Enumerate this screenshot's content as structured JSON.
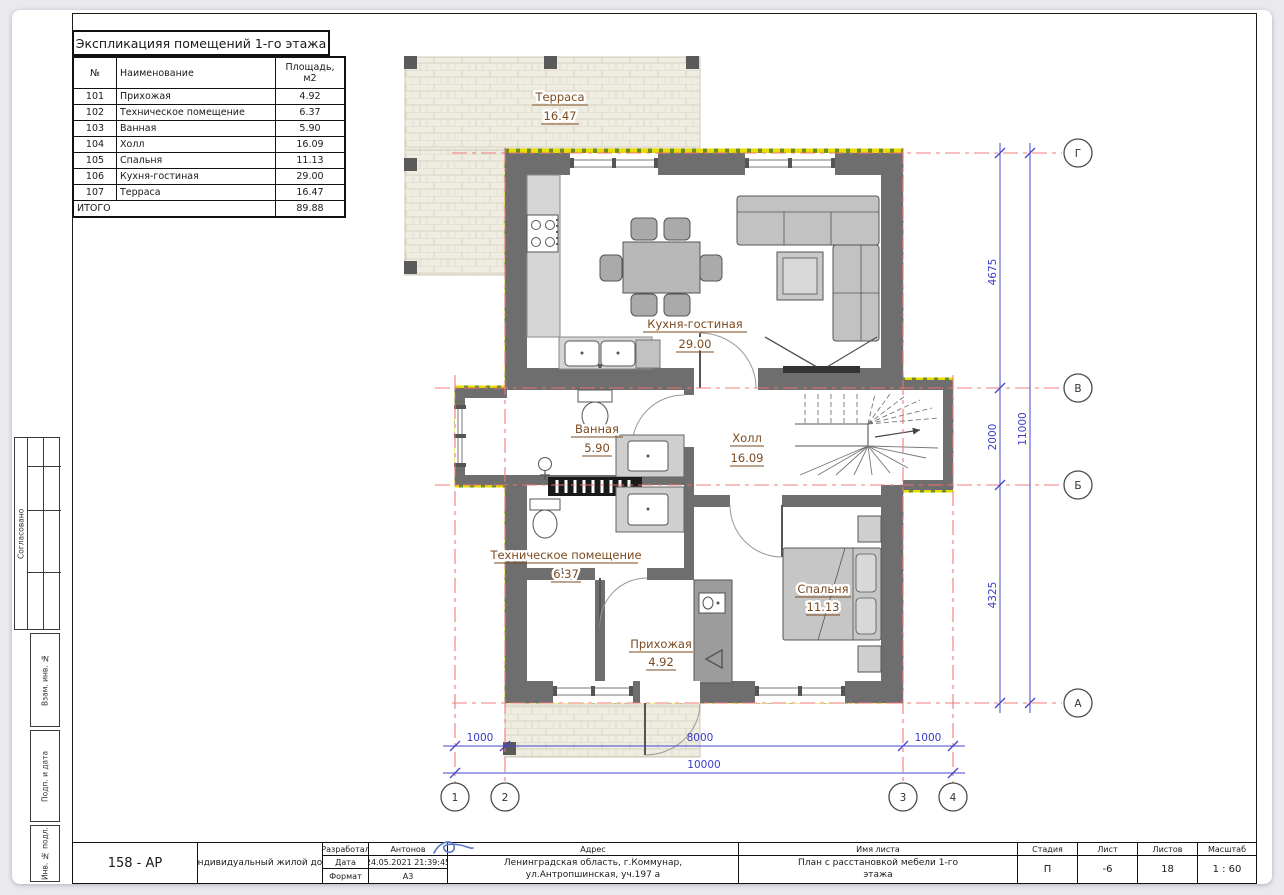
{
  "schedule": {
    "title": "Экспликацияя помещений 1-го этажа",
    "col_num": "№",
    "col_name": "Наименование",
    "col_area_line1": "Площадь,",
    "col_area_line2": "м2",
    "rows": [
      {
        "num": "101",
        "name": "Прихожая",
        "area": "4.92"
      },
      {
        "num": "102",
        "name": "Техническое помещение",
        "area": "6.37"
      },
      {
        "num": "103",
        "name": "Ванная",
        "area": "5.90"
      },
      {
        "num": "104",
        "name": "Холл",
        "area": "16.09"
      },
      {
        "num": "105",
        "name": "Спальня",
        "area": "11.13"
      },
      {
        "num": "106",
        "name": "Кухня-гостиная",
        "area": "29.00"
      },
      {
        "num": "107",
        "name": "Терраса",
        "area": "16.47"
      }
    ],
    "total_label": "ИТОГО",
    "total_area": "89.88"
  },
  "plan": {
    "rooms": [
      {
        "name": "Терраса",
        "area": "16.47"
      },
      {
        "name": "Кухня-гостиная",
        "area": "29.00"
      },
      {
        "name": "Ванная",
        "area": "5.90"
      },
      {
        "name": "Холл",
        "area": "16.09"
      },
      {
        "name": "Техническое помещение",
        "area": "6.37"
      },
      {
        "name": "Прихожая",
        "area": "4.92"
      },
      {
        "name": "Спальня",
        "area": "11.13"
      }
    ],
    "dims_bottom": [
      "1000",
      "8000",
      "1000"
    ],
    "dim_bottom_total": "10000",
    "dims_right": [
      "4675",
      "2000",
      "4325"
    ],
    "dim_right_total": "11000",
    "axis_cols": [
      "1",
      "2",
      "3",
      "4"
    ],
    "axis_rows": [
      "Г",
      "В",
      "Б",
      "А"
    ]
  },
  "sidebar": {
    "agreed": "Согласовано",
    "vzam": "Взам. инв. №",
    "podp": "Подп. и дата",
    "inv": "Инв. № подл."
  },
  "titleblock": {
    "code": "158 - АР",
    "project": "Индивидуальный жилой дом",
    "developed_label": "Разработал",
    "developed_value": "Антонов",
    "date_label": "Дата",
    "date_value": "24.05.2021 21:39:45",
    "format_label": "Формат",
    "format_value": "А3",
    "address_label": "Адрес",
    "address_line1": "Ленинградская область, г.Коммунар,",
    "address_line2": "ул.Антропшинская, уч.197 а",
    "sheetname_label": "Имя листа",
    "sheetname_line1": "План с расстановкой мебели 1-го",
    "sheetname_line2": "этажа",
    "stage_label": "Стадия",
    "stage_value": "П",
    "sheet_label": "Лист",
    "sheet_value": "-6",
    "sheets_label": "Листов",
    "sheets_value": "18",
    "scale_label": "Масштаб",
    "scale_value": "1 : 60"
  },
  "colors": {
    "dimension_blue": "#4444cc",
    "axis_red": "#f07474",
    "label_brown": "#7b4a1f",
    "wall_gray": "#6e6e6e",
    "insulation_yellow": "#e6de00",
    "insulation_olive": "#728c1e"
  }
}
